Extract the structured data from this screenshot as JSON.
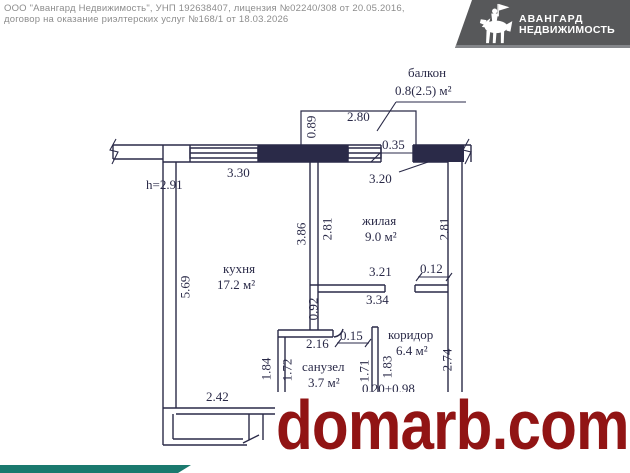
{
  "header": {
    "line1": "ООО \"Авангард Недвижимость\", УНП 192638407, лицензия №02240/308 от 20.05.2016,",
    "line2": "договор на оказание риэлтерских услуг №168/1 от 18.03.2026"
  },
  "logo": {
    "title": "АВАНГАРД",
    "subtitle": "НЕДВИЖИМОСТЬ",
    "background_color": "#57585a",
    "icon": "knight-with-flag-icon"
  },
  "plan": {
    "ink_color": "#2a2a48",
    "height_note": "h=2.91",
    "rooms": {
      "balcony": {
        "name": "балкон",
        "area": "0.8(2.5) м²"
      },
      "living": {
        "name": "жилая",
        "area": "9.0 м²"
      },
      "kitchen": {
        "name": "кухня",
        "area": "17.2 м²"
      },
      "corridor": {
        "name": "коридор",
        "area": "6.4 м²"
      },
      "bathroom": {
        "name": "санузел",
        "area": "3.7 м²"
      }
    },
    "dims": {
      "balcony_width": "2.80",
      "balcony_depth": "0.89",
      "balcony_door": "0.35",
      "kitchen_window": "3.30",
      "living_top": "3.20",
      "living_wall_left_outer": "3.86",
      "living_left": "2.81",
      "living_right": "2.81",
      "living_bottom": "3.21",
      "wall_stub": "0.12",
      "living_bottom_outer": "3.34",
      "kitchen_height": "5.69",
      "mid_wall": "0.92",
      "bath_width": "2.16",
      "bath_door": "0.15",
      "bath_left_outer": "1.84",
      "bath_left": "1.72",
      "bath_right": "1.71",
      "corridor_left": "1.83",
      "corridor_right": "2.74",
      "kitchen_bottom": "2.42",
      "corridor_bottom": "0.20+0.98"
    }
  },
  "watermark": {
    "text": "domarb.com",
    "color": "#911414"
  },
  "footer": {
    "accent_color": "#1a796e"
  }
}
